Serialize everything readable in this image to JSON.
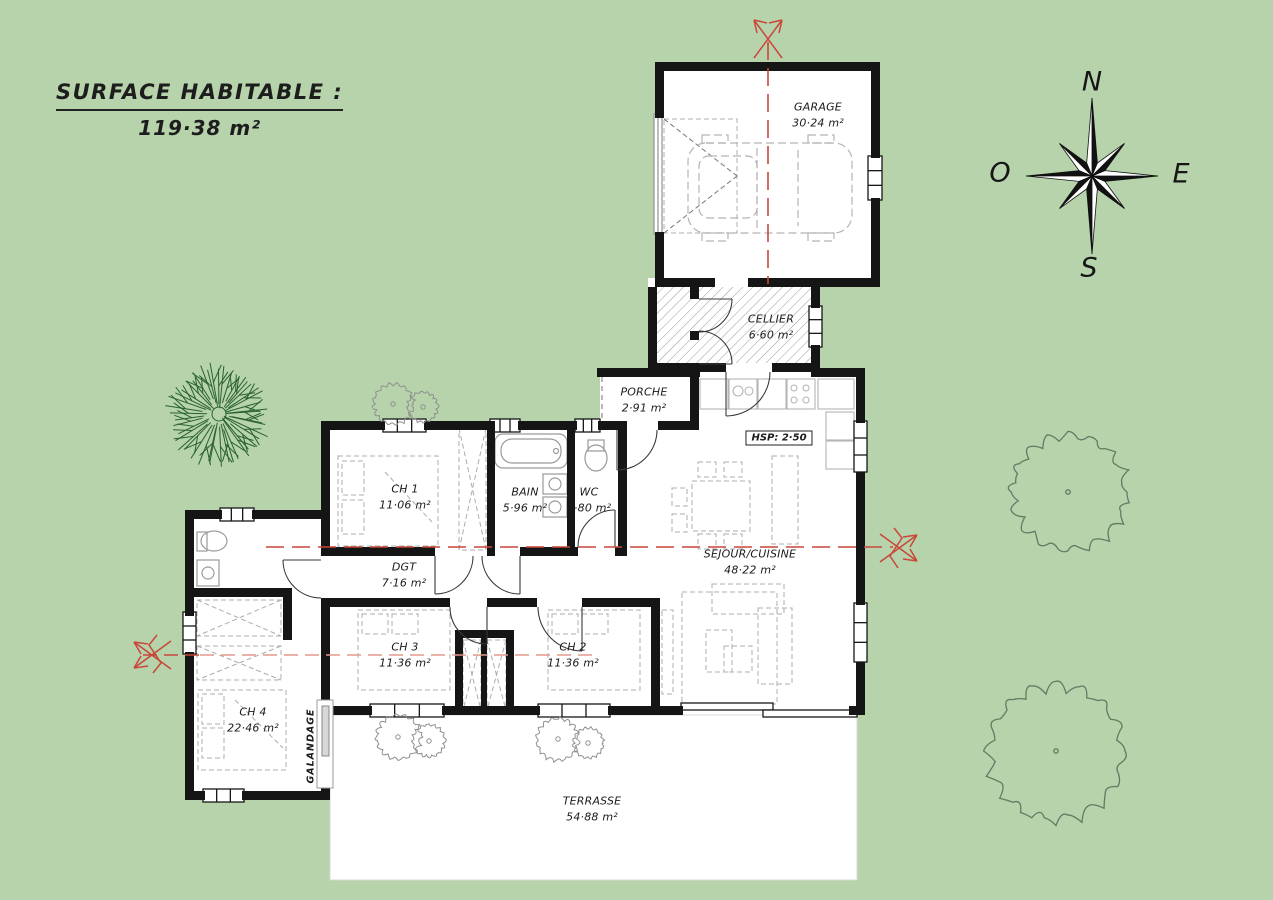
{
  "title": {
    "line1": "SURFACE HABITABLE :",
    "line2": "119·38 m²"
  },
  "compass": {
    "north": "N",
    "east": "E",
    "south": "S",
    "west": "O"
  },
  "rooms": {
    "garage": {
      "name": "GARAGE",
      "area": "30·24 m²"
    },
    "cellier": {
      "name": "CELLIER",
      "area": "6·60 m²"
    },
    "porche": {
      "name": "PORCHE",
      "area": "2·91 m²"
    },
    "sejour": {
      "name": "SEJOUR/CUISINE",
      "area": "48·22 m²"
    },
    "ch1": {
      "name": "CH 1",
      "area": "11·06 m²"
    },
    "bain": {
      "name": "BAIN",
      "area": "5·96 m²"
    },
    "wc": {
      "name": "WC",
      "area": "1·80 m²"
    },
    "dgt": {
      "name": "DGT",
      "area": "7·16 m²"
    },
    "ch3": {
      "name": "CH 3",
      "area": "11·36 m²"
    },
    "ch2": {
      "name": "CH 2",
      "area": "11·36 m²"
    },
    "ch4": {
      "name": "CH 4",
      "area": "22·46 m²"
    },
    "terrasse": {
      "name": "TERRASSE",
      "area": "54·88 m²"
    }
  },
  "annotations": {
    "hsp": "HSP: 2·50",
    "galandage": "GALANDAGE"
  },
  "colors": {
    "background": "#b6d3ab",
    "wall": "#151515",
    "axis_red": "#c9473a",
    "axis_red_light": "#e29a8e",
    "tree_green": "#2a6132",
    "tree_outline": "#5e7d63",
    "bush_gray": "#8f8f8f"
  }
}
